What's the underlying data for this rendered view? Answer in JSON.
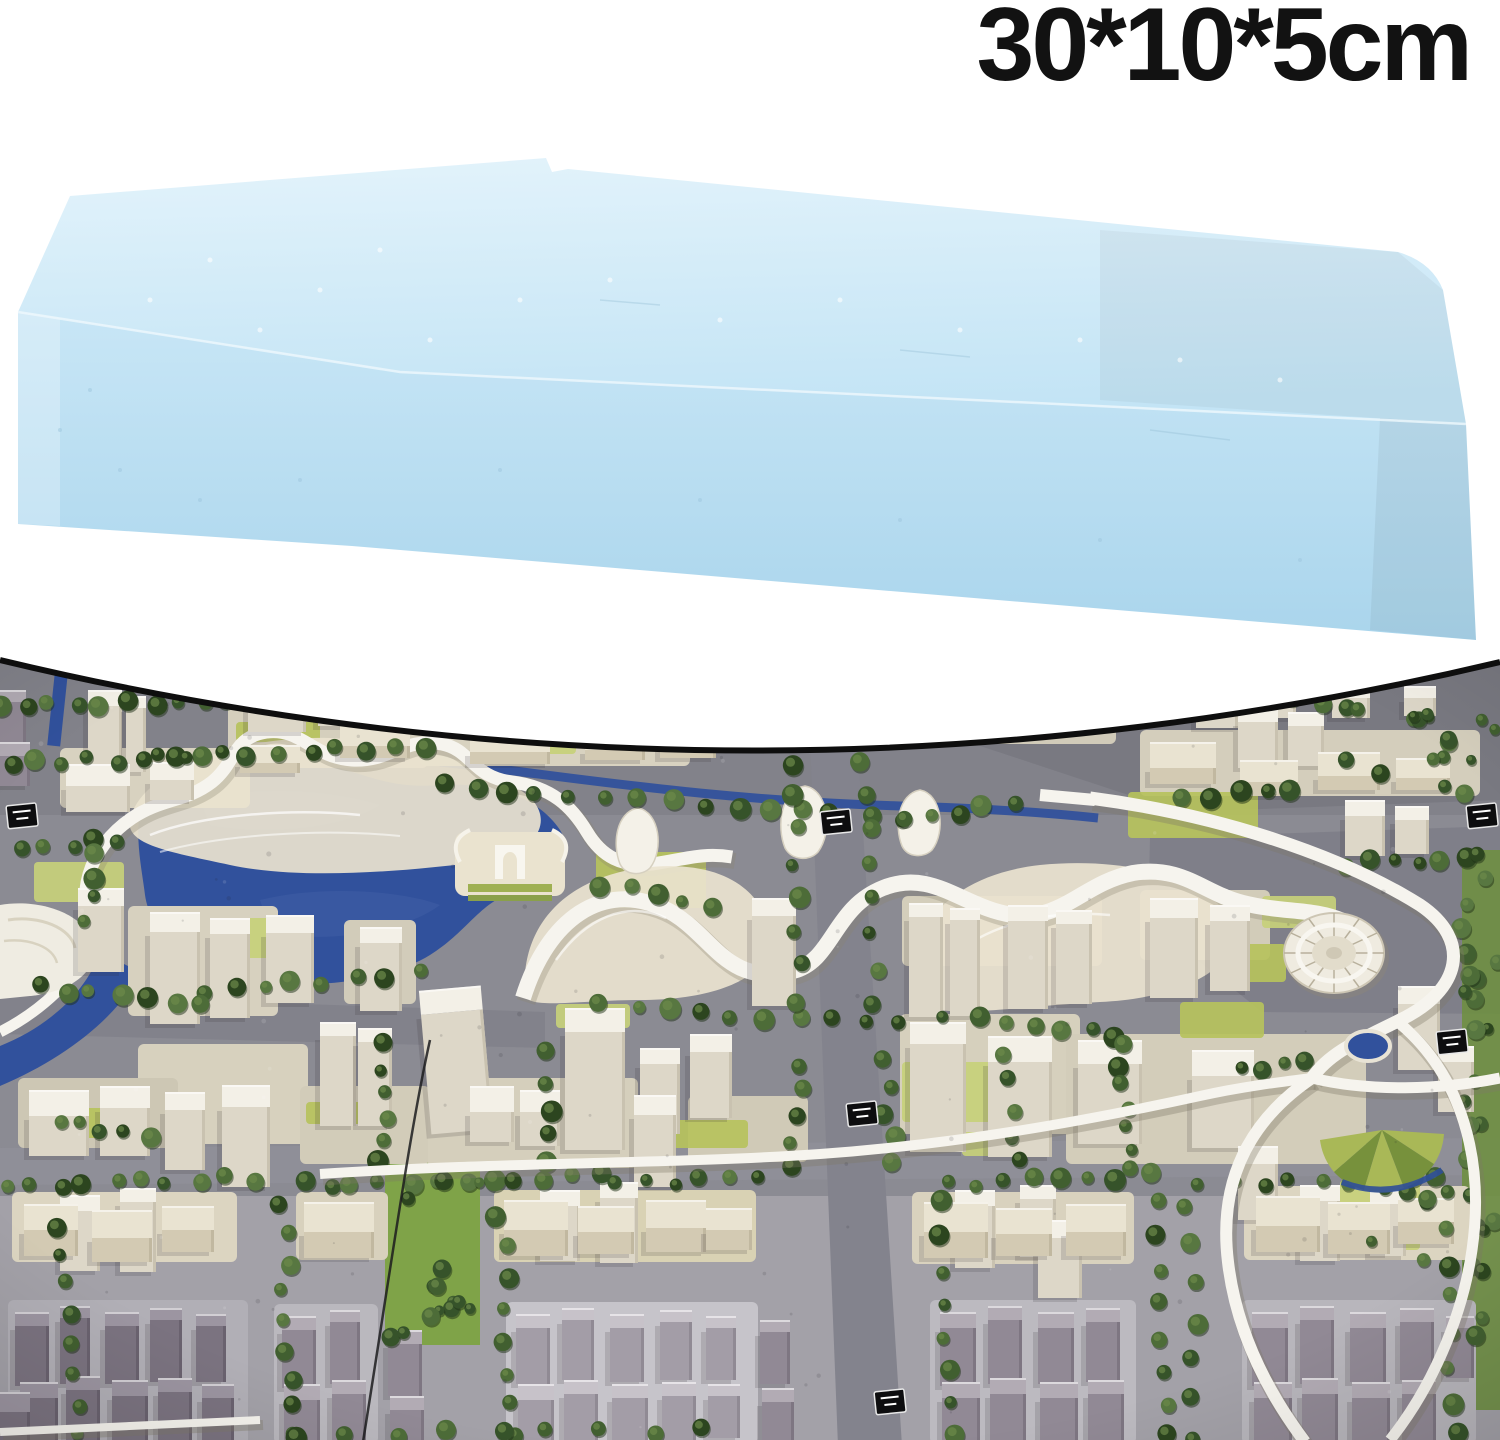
{
  "size_label": {
    "text": "30*10*5cm",
    "color": "#121212"
  },
  "product": {
    "name": "light blue rectangular modeling foam block",
    "dimensions_cm": "30*10*5",
    "colors": {
      "top_face": "#cfe9f7",
      "front_face": "#b7dcf0",
      "edge_highlight": "#eef8fd",
      "speckle": "#9dc6dd"
    }
  },
  "photo": {
    "name": "architectural city scale model photograph",
    "colors": {
      "background_white": "#ffffff",
      "border_black": "#0e0e0e",
      "road_gray": "#8b8b93",
      "road_dark": "#75757e",
      "ground_light": "#a3a1a8",
      "water_blue": "#31519c",
      "water_light": "#4a66ad",
      "tree_green": "#36532a",
      "lawn_green": "#b6c25c",
      "band_green": "#7fa348",
      "white_building_roof": "#f3f0e7",
      "white_building_wall": "#ddd7c8",
      "cream_building_roof": "#e9e3d1",
      "gray_building_roof": "#b2abb4",
      "gray_building_wall": "#918995",
      "seam_black": "#1c1c1f",
      "highway_white": "#f6f4ee"
    }
  }
}
